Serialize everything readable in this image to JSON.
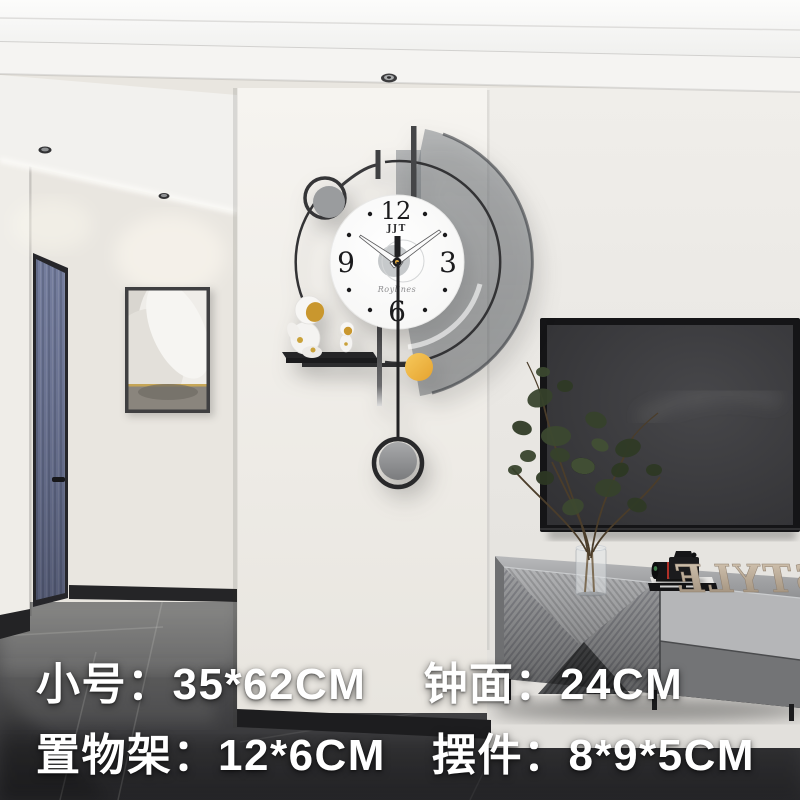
{
  "overlay": {
    "size_label": "小号：",
    "size_value": "35*62CM",
    "face_label": "钟面：",
    "face_value": "24CM",
    "shelf_label": "置物架：",
    "shelf_value": "12*6CM",
    "ornament_label": "摆件：",
    "ornament_value": "8*9*5CM"
  },
  "clock": {
    "brand": "JJT",
    "signature": "Roylines",
    "numerals": {
      "n12": "12",
      "n3": "3",
      "n6": "6",
      "n9": "9"
    },
    "hands_time": "10:09",
    "accent_color": "#F2B84B",
    "pendulum_color": "#8F9092"
  },
  "decor": {
    "mirrored_letters": "STYLE"
  },
  "palette": {
    "main_wall": "#F4F2EE",
    "hall_wall": "#E9E6E0",
    "floor_dark": "#2C2C2E",
    "tv_screen": "#3B3B3D",
    "gold_accent": "#C9A23E"
  }
}
